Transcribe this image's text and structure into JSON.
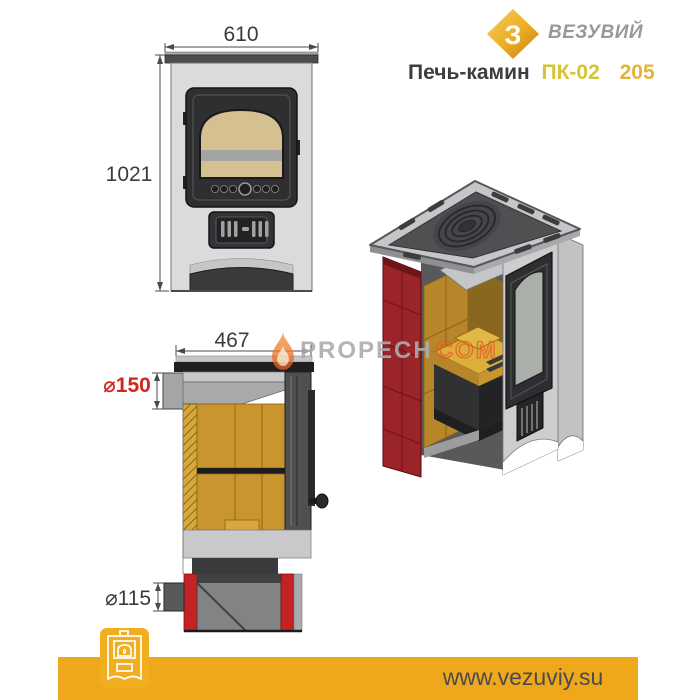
{
  "header": {
    "brand": "ВЕЗУВИЙ",
    "logo_letter": "З",
    "title_prefix": "Печь-камин",
    "title_model": "ПК-02",
    "title_variant": "205"
  },
  "dimensions": {
    "front_width": "610",
    "front_height": "1021",
    "section_depth": "467",
    "flue_diameter": "⌀150",
    "ash_outlet_diameter": "⌀115"
  },
  "watermark": {
    "name": "PROPECH",
    "suffix": "COM"
  },
  "footer": {
    "url": "www.vezuviy.su"
  },
  "colors": {
    "accent_gold": "#EFA71C",
    "badge_gold": "#F1AE1E",
    "model_yellow": "#D5C433",
    "variant_gold": "#E3B23A",
    "dimension_red": "#D2251E",
    "firebrick_yellow": "#C9952E",
    "tile_red": "#9B2428",
    "ash_pan_red": "#C42326",
    "body_gray": "#D9D9DB",
    "glass_tan": "#D4C091"
  }
}
